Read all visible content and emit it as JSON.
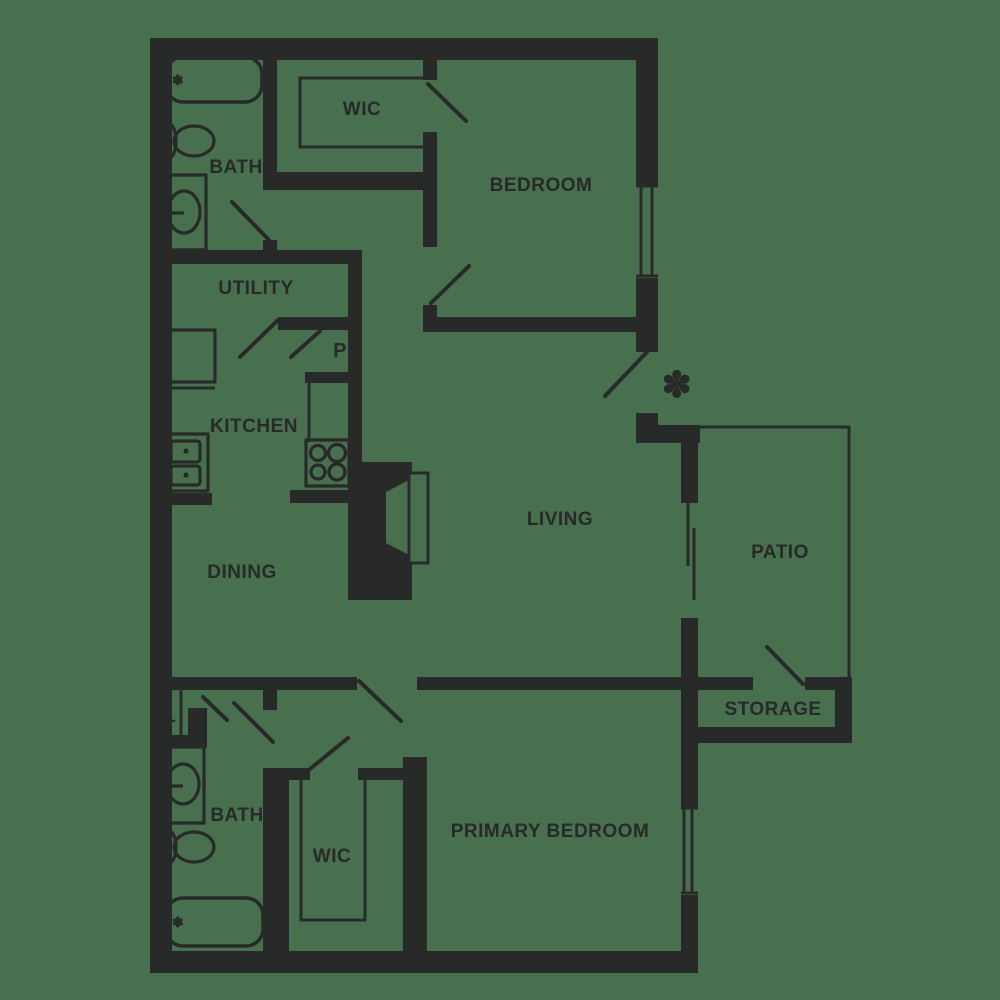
{
  "title": "Two bedroom apartment floor plan",
  "colors": {
    "background": "#48704F",
    "ink": "#272A28"
  },
  "rooms": {
    "wic_top": {
      "label": "WIC"
    },
    "bath_top": {
      "label": "BATH"
    },
    "bedroom": {
      "label": "BEDROOM"
    },
    "utility": {
      "label": "UTILITY"
    },
    "pantry": {
      "label": "P"
    },
    "kitchen": {
      "label": "KITCHEN"
    },
    "dining": {
      "label": "DINING"
    },
    "living": {
      "label": "LIVING"
    },
    "patio": {
      "label": "PATIO"
    },
    "storage": {
      "label": "STORAGE"
    },
    "linen": {
      "label": "L"
    },
    "bath_bottom": {
      "label": "BATH"
    },
    "wic_bottom": {
      "label": "WIC"
    },
    "primary_bedroom": {
      "label": "PRIMARY BEDROOM"
    }
  },
  "symbols": {
    "entry_marker": "✽",
    "tub_faucet_top": "✽",
    "tub_faucet_bottom": "✽"
  }
}
